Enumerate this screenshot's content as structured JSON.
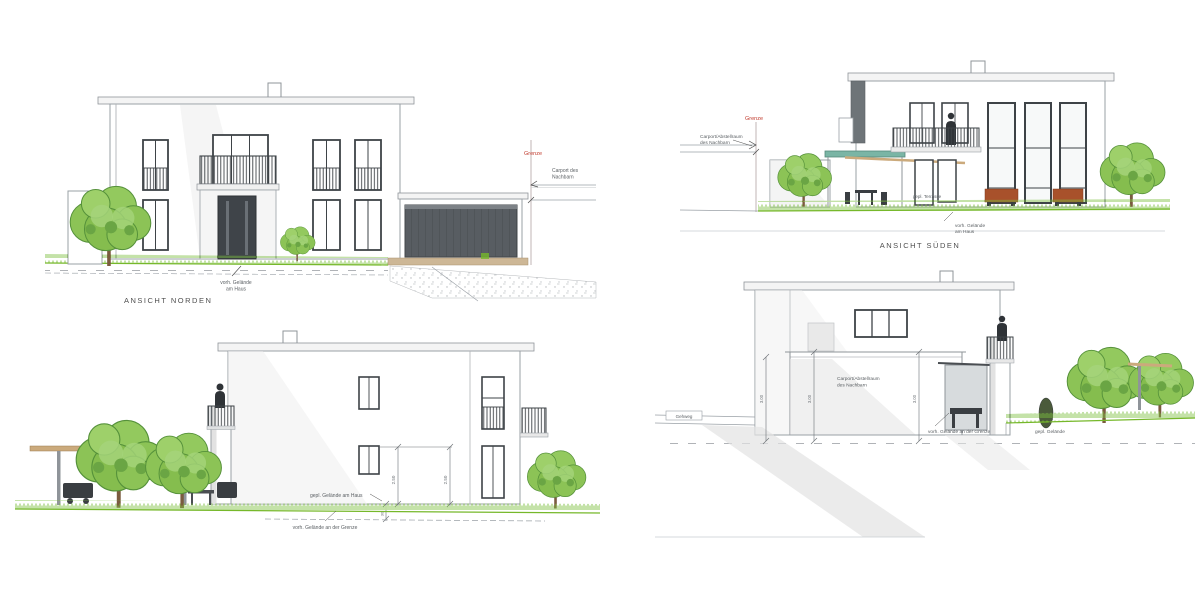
{
  "page": {
    "background": "#ffffff"
  },
  "colors": {
    "line": "#9aa0a6",
    "frame_dark": "#3e4347",
    "garage_door": "#585d62",
    "grass": "#7cbf3f",
    "tree_green": "#8cc356",
    "boundary_red": "#c0392b",
    "canopy_teal": "#7ab5a5",
    "planter_brown": "#a8512b",
    "slab_beige": "#cdb796"
  },
  "views": {
    "north": {
      "caption": "ANSICHT NORDEN",
      "boundary_label": "Grenze",
      "neighbor_note_line1": "Carport des",
      "neighbor_note_line2": "Nachbarn",
      "ground_note_line1": "vorh. Gelände",
      "ground_note_line2": "am Haus"
    },
    "south": {
      "caption": "ANSICHT SÜDEN",
      "boundary_label": "Grenze",
      "neighbor_note_line1": "Carport/Abstellraum",
      "neighbor_note_line2": "des Nachbarn",
      "terrace_note": "gepl. Terrasse",
      "ground_note_line1": "vorh. Gelände",
      "ground_note_line2": "am Haus"
    },
    "side_left": {
      "dim_a": "2.50",
      "dim_b": "2.50",
      "dim_c": "30",
      "planned_ground_note": "gepl. Gelände am Haus",
      "existing_ground_note": "vorh. Gelände an der Grenze"
    },
    "side_right": {
      "carport_label_line1": "Carport/Abstellraum",
      "carport_label_line2": "des Nachbarn",
      "walkway_label": "Gehweg",
      "existing_ground_note": "vorh. Gelände an der Grenze",
      "planned_ground_note": "gepl. Gelände",
      "dim_a": "3.00",
      "dim_b": "3.00",
      "dim_c": "3.00"
    }
  }
}
